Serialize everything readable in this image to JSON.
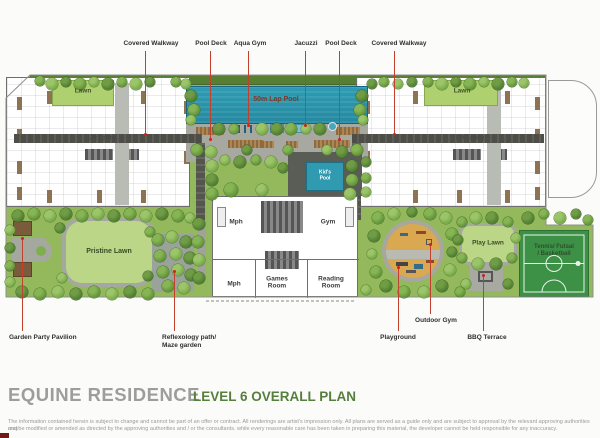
{
  "colors": {
    "accent_red": "#c2402e",
    "title_gray": "#9d9d9b",
    "title_green": "#567f3e",
    "pool_blue": "#2d95ac",
    "site_green": "#93b95c",
    "court_green": "#3c9146",
    "playground_tan": "#d9a850"
  },
  "title": {
    "project": "EQUINE RESIDENCE",
    "plan": "LEVEL 6 OVERALL PLAN"
  },
  "disclaimer": {
    "line1": "The information contained herein is subject to change and cannot be part of an offer or contract. All renderings are artist's impression only. All plans are served as a guide only and are subject to approval by the relevant approving authorities and",
    "line2": "maybe modified or amended as directed by the approving authorities and / or the consultants. while every reasonable care has been taken in preparing this material, the developer cannot be held responsible for any inaccuracy."
  },
  "plan_labels": {
    "lawn_left": "Lawn",
    "lawn_right": "Lawn",
    "lap_pool": "50m Lap Pool",
    "lift_lobby_left": "Lift Lobby",
    "lift_lobby_right": "Lift Lobby",
    "kids_pool": "Kid's\nPool",
    "mph_upper": "Mph",
    "gym": "Gym",
    "mph_lower": "Mph",
    "games_room": "Games\nRoom",
    "reading_room": "Reading\nRoom",
    "pristine_lawn": "Pristine Lawn",
    "play_lawn": "Play Lawn",
    "tennis_court": "Tennis/ Futsal\n/ Basketball"
  },
  "annotations": {
    "top": [
      {
        "label": "Covered Walkway",
        "cx": 151,
        "lx": 145,
        "y1": 51,
        "y2": 134
      },
      {
        "label": "Pool Deck",
        "cx": 211,
        "lx": 210,
        "y1": 51,
        "y2": 139
      },
      {
        "label": "Aqua Gym",
        "cx": 250,
        "lx": 248,
        "y1": 51,
        "y2": 125
      },
      {
        "label": "Jacuzzi",
        "cx": 306,
        "lx": 305,
        "y1": 51,
        "y2": 125
      },
      {
        "label": "Pool Deck",
        "cx": 341,
        "lx": 339,
        "y1": 51,
        "y2": 139
      },
      {
        "label": "Covered Walkway",
        "cx": 399,
        "lx": 394,
        "y1": 51,
        "y2": 134
      }
    ],
    "bottom": [
      {
        "label": "Garden Party Pavilion",
        "tx": 9,
        "ty": 334,
        "lx": 22,
        "y1": 237,
        "y2": 331,
        "align": "left"
      },
      {
        "label": "Reflexology path/\nMaze garden",
        "tx": 162,
        "ty": 334,
        "lx": 174,
        "y1": 270,
        "y2": 331,
        "align": "left"
      },
      {
        "label": "Playground",
        "tx": 398,
        "ty": 334,
        "lx": 398,
        "y1": 266,
        "y2": 331,
        "align": "center"
      },
      {
        "label": "Outdoor Gym",
        "tx": 436,
        "ty": 317,
        "lx": 430,
        "y1": 243,
        "y2": 314,
        "align": "center"
      },
      {
        "label": "BBQ Terrace",
        "tx": 487,
        "ty": 334,
        "lx": 483,
        "y1": 274,
        "y2": 331,
        "align": "center"
      }
    ]
  }
}
